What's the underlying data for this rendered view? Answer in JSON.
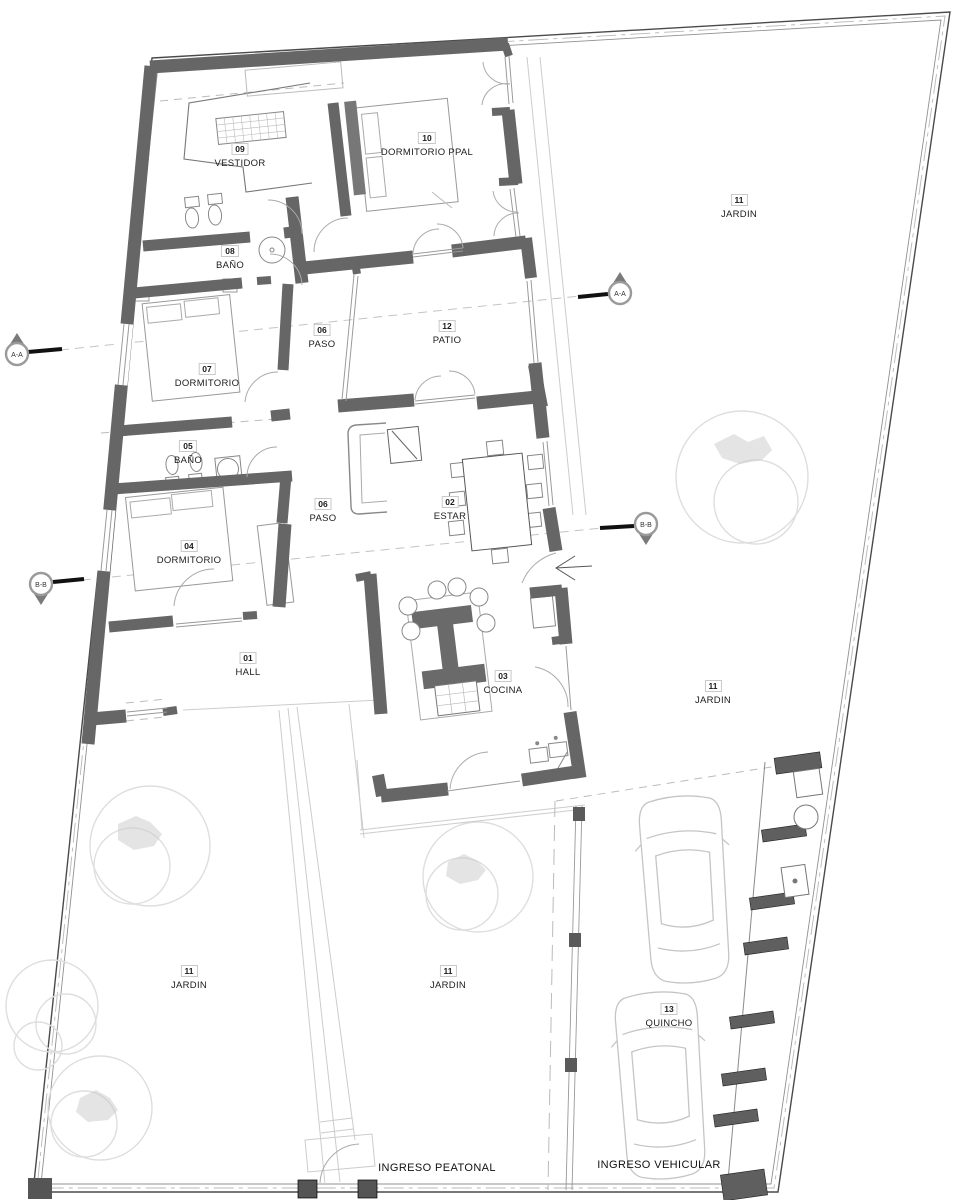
{
  "plan": {
    "rooms": [
      {
        "num": "09",
        "name": "VESTIDOR"
      },
      {
        "num": "10",
        "name": "DORMITORIO PPAL"
      },
      {
        "num": "11",
        "name": "JARDIN"
      },
      {
        "num": "08",
        "name": "BAÑO"
      },
      {
        "num": "06",
        "name": "PASO"
      },
      {
        "num": "12",
        "name": "PATIO"
      },
      {
        "num": "07",
        "name": "DORMITORIO"
      },
      {
        "num": "05",
        "name": "BAÑO"
      },
      {
        "num": "02",
        "name": "ESTAR"
      },
      {
        "num": "06",
        "name": "PASO"
      },
      {
        "num": "04",
        "name": "DORMITORIO"
      },
      {
        "num": "01",
        "name": "HALL"
      },
      {
        "num": "03",
        "name": "COCINA"
      },
      {
        "num": "11",
        "name": "JARDIN"
      },
      {
        "num": "11",
        "name": "JARDIN"
      },
      {
        "num": "11",
        "name": "JARDIN"
      },
      {
        "num": "13",
        "name": "QUINCHO"
      }
    ],
    "entrances": {
      "pedestrian": "INGRESO PEATONAL",
      "vehicular": "INGRESO VEHICULAR"
    },
    "sections": {
      "a": "A-A",
      "b": "B-B"
    },
    "colors": {
      "wall": "#666666",
      "boundary": "#4a4a4a",
      "light_line": "#cccccc"
    }
  }
}
